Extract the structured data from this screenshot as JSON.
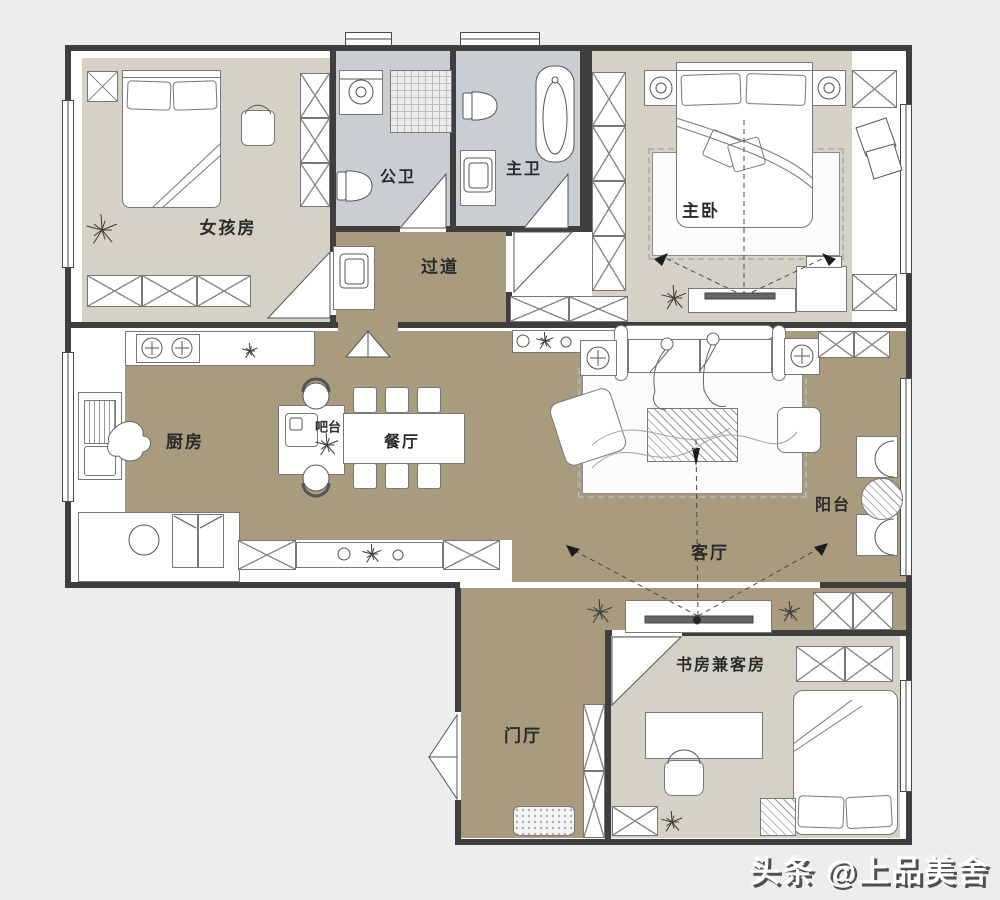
{
  "plan": {
    "watermark": "头条 @上品美舍",
    "colors": {
      "background": "#ededed",
      "floor_open": "#a89b7e",
      "floor_room": "#d4d2c6",
      "floor_bath": "#c9ced3",
      "wall": "#3e3e3e"
    },
    "rooms": [
      {
        "id": "girls-room",
        "label": "女孩房"
      },
      {
        "id": "public-bath",
        "label": "公卫"
      },
      {
        "id": "master-bath",
        "label": "主卫"
      },
      {
        "id": "master-bedroom",
        "label": "主卧"
      },
      {
        "id": "corridor",
        "label": "过道"
      },
      {
        "id": "kitchen",
        "label": "厨房"
      },
      {
        "id": "bar-counter",
        "label": "吧台"
      },
      {
        "id": "dining-room",
        "label": "餐厅"
      },
      {
        "id": "living-room",
        "label": "客厅"
      },
      {
        "id": "balcony",
        "label": "阳台"
      },
      {
        "id": "foyer",
        "label": "门厅"
      },
      {
        "id": "study-guest-room",
        "label": "书房兼客房"
      }
    ]
  }
}
